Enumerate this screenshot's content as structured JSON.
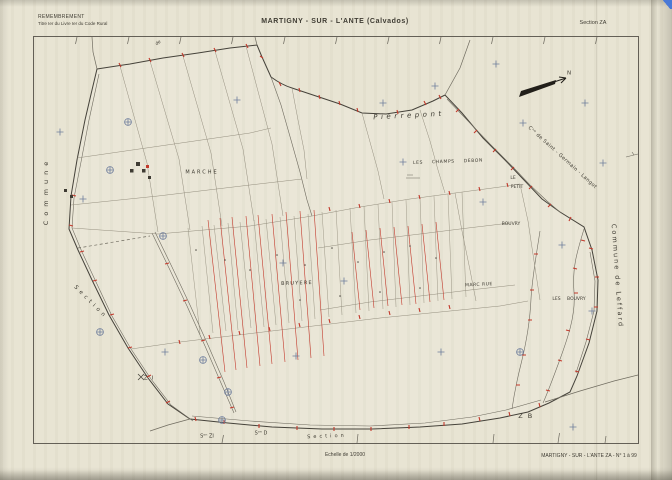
{
  "document": {
    "procedure": "REMEMBREMENT",
    "procedure_ref": "Titre Ier du Livre Ier du Code Rural",
    "title": "MARTIGNY - SUR - L'ANTE (Calvados)",
    "section": "Section ZA",
    "scale": "Echelle de 1/2000",
    "sheet_ref": "MARTIGNY - SUR - L'ANTE ZA - N° 1 à 99"
  },
  "colors": {
    "paper": "#e8e4d3",
    "ink": "#3f3c33",
    "boundary_ink": "#45423a",
    "parcel_red": "#c2392b",
    "survey_blue": "#6e7d9c"
  },
  "map_labels": [
    {
      "id": "lieu-pierrepont",
      "text": "Pierrepont",
      "x": 409,
      "y": 116,
      "size": 7,
      "ls": 3.5,
      "rot": -3,
      "italic": true
    },
    {
      "id": "road-label-de",
      "text": "de",
      "x": 159,
      "y": 44,
      "size": 4.5,
      "rot": -35,
      "italic": true
    },
    {
      "id": "commune-saint-germain-langot",
      "text": "Cⁿᵉ de Saint - Germain - Langot",
      "x": 562,
      "y": 158,
      "size": 5,
      "ls": 0.4,
      "rot": 42
    },
    {
      "id": "commune-left-label",
      "text": "Commune",
      "x": 46,
      "y": 191,
      "size": 6.5,
      "ls": 5,
      "rot": -90
    },
    {
      "id": "section-left-label",
      "text": "Section",
      "x": 90,
      "y": 303,
      "size": 5.5,
      "ls": 3.5,
      "rot": 45
    },
    {
      "id": "lieu-marche",
      "text": "MARCHE",
      "x": 202,
      "y": 173,
      "size": 5,
      "ls": 2
    },
    {
      "id": "lieu-les-champs-debon",
      "text": "LES CHAMPS DEBON",
      "x": 448,
      "y": 163,
      "size": 4.5,
      "ls": 0.6,
      "ws": 7,
      "rot": -2
    },
    {
      "id": "lieu-le-petit-bouvry-1",
      "text": "LE",
      "x": 513,
      "y": 179,
      "size": 4.5
    },
    {
      "id": "lieu-le-petit-bouvry-2",
      "text": "PETIT",
      "x": 517,
      "y": 188,
      "size": 4.5
    },
    {
      "id": "lieu-le-petit-bouvry-3",
      "text": "BOUVRY",
      "x": 511,
      "y": 225,
      "size": 4.5
    },
    {
      "id": "lieu-bruyere",
      "text": "BRUYERE",
      "x": 297,
      "y": 284,
      "size": 5,
      "ls": 1.2,
      "rot": -2
    },
    {
      "id": "lieu-marc-rue",
      "text": "MARC RUE",
      "x": 479,
      "y": 286,
      "size": 4.5,
      "ls": 0.5,
      "rot": -3
    },
    {
      "id": "lieu-les-bouvry",
      "text": "LES BOUVRY",
      "x": 569,
      "y": 300,
      "size": 4.5,
      "ws": 5
    },
    {
      "id": "commune-leffard-label",
      "text": "Commune de Leffard",
      "x": 617,
      "y": 276,
      "size": 6.5,
      "ls": 2,
      "rot": 86
    },
    {
      "id": "section-zb-label",
      "text": "Z B",
      "x": 526,
      "y": 416,
      "size": 6.5,
      "ls": 1.5
    },
    {
      "id": "section-zi-label",
      "text": "Z I",
      "x": 149,
      "y": 379,
      "size": 5.5,
      "ls": 1
    },
    {
      "id": "section-zi-ref",
      "text": "Sᵒⁿ ZI",
      "x": 207,
      "y": 437,
      "size": 5
    },
    {
      "id": "section-d-ref",
      "text": "Sᵒⁿ D",
      "x": 261,
      "y": 434,
      "size": 5
    },
    {
      "id": "section-bottom-label",
      "text": "Section",
      "x": 327,
      "y": 437,
      "size": 5,
      "ls": 3,
      "rot": -2
    },
    {
      "id": "north-label",
      "text": "N",
      "x": 569,
      "y": 74,
      "size": 5.5
    }
  ]
}
